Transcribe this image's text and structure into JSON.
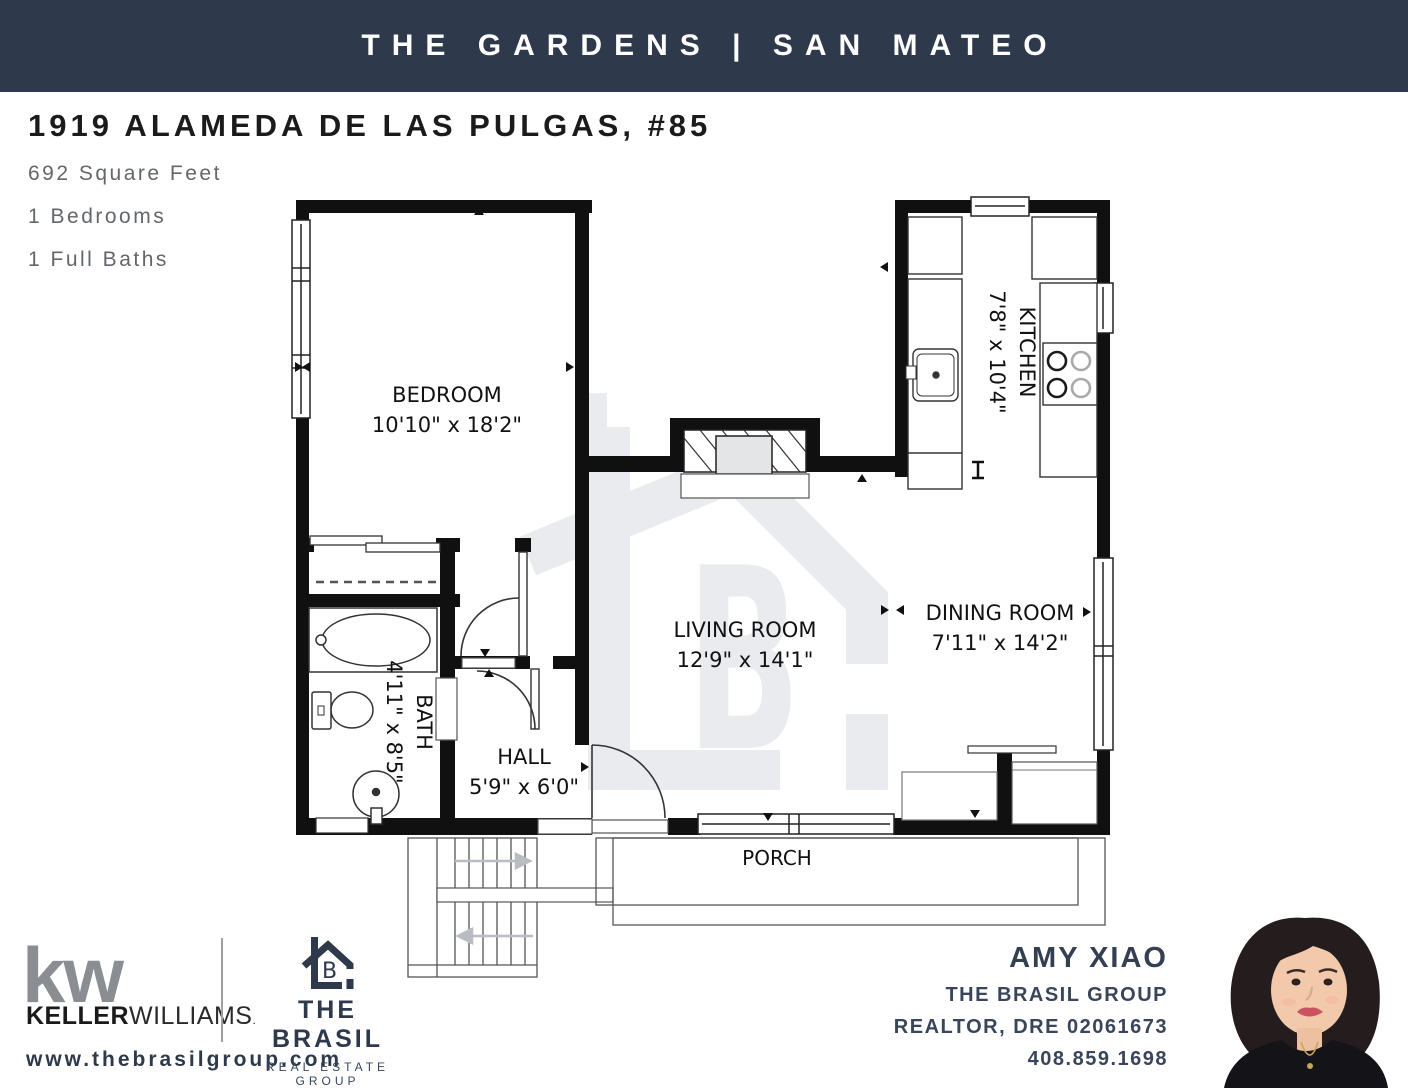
{
  "banner": {
    "title": "THE GARDENS | SAN MATEO"
  },
  "listing": {
    "address": "1919 ALAMEDA DE LAS PULGAS, #85",
    "facts": [
      "692 Square Feet",
      "1 Bedrooms",
      "1 Full Baths"
    ]
  },
  "floorplan": {
    "rooms": [
      {
        "name": "BEDROOM",
        "dims": "10'10\" x 18'2\""
      },
      {
        "name": "KITCHEN",
        "dims": "7'8\" x 10'4\""
      },
      {
        "name": "LIVING ROOM",
        "dims": "12'9\" x 14'1\""
      },
      {
        "name": "DINING ROOM",
        "dims": "7'11\" x 14'2\""
      },
      {
        "name": "BATH",
        "dims": "4'11\" x 8'5\""
      },
      {
        "name": "HALL",
        "dims": "5'9\" x 6'0\""
      },
      {
        "name": "PORCH",
        "dims": ""
      }
    ]
  },
  "footer": {
    "kw": {
      "mark": "kw",
      "name_bold": "KELLER",
      "name_light": "WILLIAMS",
      "tm": "."
    },
    "url": "www.thebrasilgroup.com",
    "brasil": {
      "line1": "THE BRASIL",
      "line2": "REAL ESTATE GROUP",
      "monogram": "B"
    },
    "agent": {
      "name": "AMY XIAO",
      "team": "THE BRASIL GROUP",
      "license": "REALTOR, DRE 02061673",
      "phone": "408.859.1698"
    }
  },
  "colors": {
    "navy": "#2E3A4C",
    "kw_gray": "#8A8D91",
    "watermark": "#E9EBEE"
  }
}
